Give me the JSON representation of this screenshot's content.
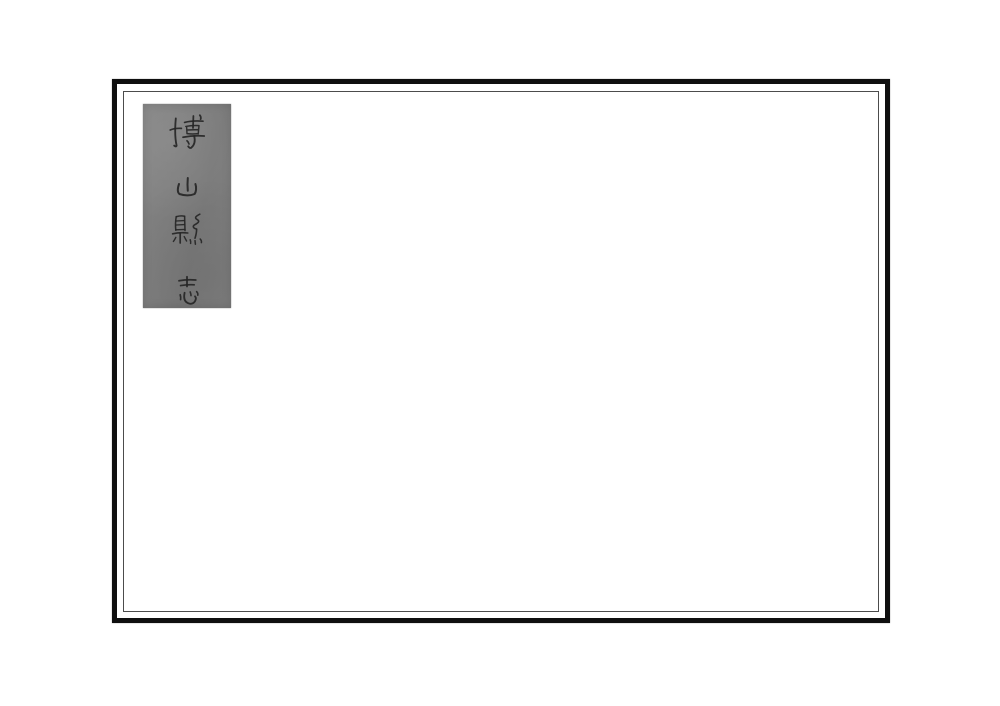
{
  "page": {
    "background": "#ffffff"
  },
  "frame": {
    "outer_border_color": "#0f0f0f",
    "inner_line_color": "#4c4c4c"
  },
  "title_label": {
    "text": "博山縣志",
    "characters": [
      "博",
      "山",
      "縣",
      "志"
    ],
    "reading_direction": "top-to-bottom",
    "background_color": "#7f7f7f",
    "ink_color": "#262626"
  }
}
